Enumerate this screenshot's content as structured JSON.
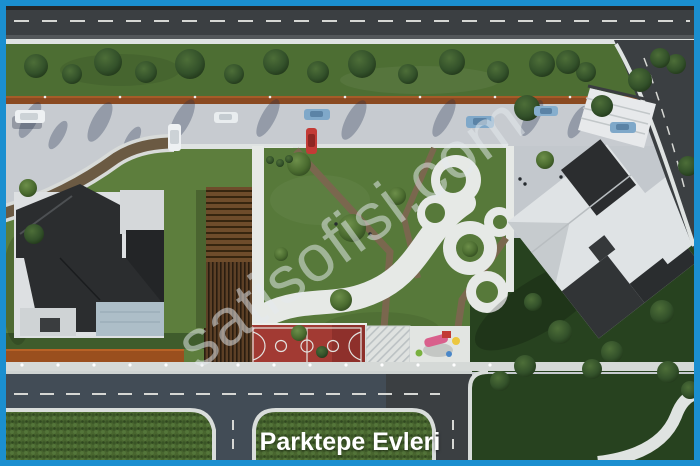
{
  "caption": {
    "title": "Parktepe Evleri"
  },
  "watermark": {
    "text": "satisofisi.com"
  },
  "palette": {
    "frame-blue": "#1b8fd0",
    "asphalt": "#3b3f42",
    "asphalt-dark": "#26282a",
    "lane-dash": "#d6d7d4",
    "curb-white": "#dfe3e2",
    "pavement": "#c7cbd0",
    "grass-strip": "#4d6e33",
    "lawn": "#5d7e3d",
    "lawn-park": "#57793a",
    "lawn-dark": "#27421f",
    "corten": "#8a4a21",
    "court-red": "#a23a33",
    "path-white": "#e6e9e6",
    "walk-brown": "#7a674e",
    "roof-dark": "#2b2d2f",
    "roof-light": "#dfe3e5",
    "caption-color": "#ffffff"
  }
}
